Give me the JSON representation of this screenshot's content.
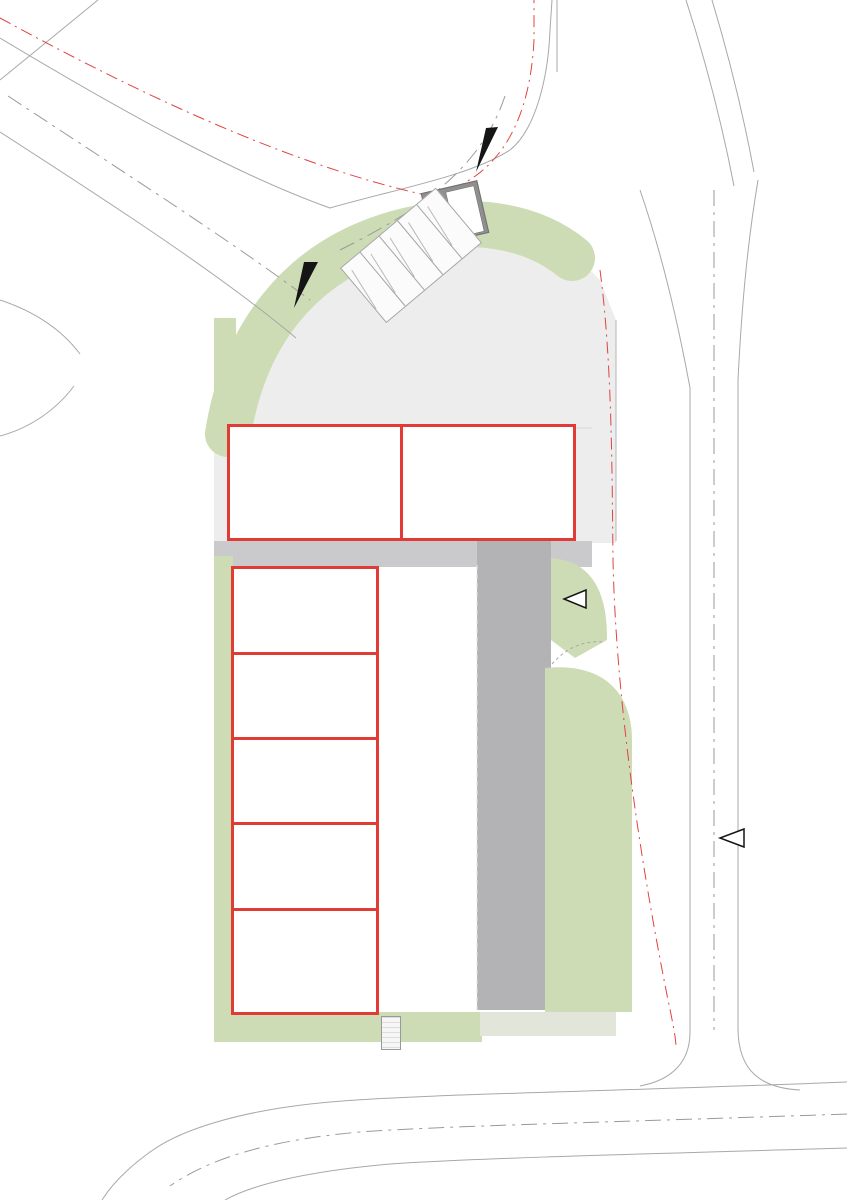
{
  "plots": {
    "a": "PLOT 30A",
    "b": "PLOT 30B"
  },
  "units": [
    {
      "label": "Unit 01"
    },
    {
      "label": "Unit 02"
    },
    {
      "label": "Unit 03"
    },
    {
      "label": "Unit 04"
    },
    {
      "label": "Unit 05"
    },
    {
      "label": "Unit 06"
    },
    {
      "label": "Unit 07"
    }
  ],
  "labels": {
    "ev_space": "EV Space",
    "visitor": "Visitor",
    "ev_active": "EV (Active Charging)",
    "ev_future": "EV (Future Provision)",
    "bin_store": "Bin Store"
  },
  "colors": {
    "unit_outline": "#e03c35",
    "landscape_green": "#cedcb5",
    "tree_green": "#a7c87e",
    "paving": "#ededee",
    "internal_road": "#b3b3b6",
    "dark_bay": "#9b9b9b",
    "ev_yellow": "#c4b636",
    "boundary_red_dash": "#e04343"
  },
  "notes": {
    "sections": [
      {
        "n": [
          95,
          90,
          97,
          60
        ]
      },
      {
        "n": [
          92,
          97,
          88,
          94,
          40
        ]
      },
      {
        "n": [
          90,
          96,
          30
        ]
      },
      {
        "n": [
          85,
          45
        ]
      },
      {
        "scalebar": true
      },
      {
        "h": "Plot 30A",
        "n": [
          88,
          80
        ]
      },
      {
        "n": [
          90,
          85,
          50
        ]
      },
      {
        "n": [
          95,
          92,
          97,
          90,
          35
        ]
      },
      {
        "n": [
          80
        ]
      },
      {
        "h": "Plot 30B",
        "n": [
          82,
          80,
          82,
          80,
          82,
          55
        ]
      },
      {
        "n": [
          75
        ]
      },
      {
        "n": [
          92,
          88,
          45
        ]
      },
      {
        "n": [
          95,
          90,
          96,
          50
        ]
      },
      {
        "n": [
          88,
          30
        ]
      },
      {
        "n": [
          94,
          97,
          92,
          96,
          90,
          40
        ]
      },
      {
        "n": [
          90,
          95,
          85,
          97,
          45
        ]
      },
      {
        "legend": [
          60,
          52,
          58,
          45,
          40
        ]
      },
      {
        "n": [
          70,
          20
        ]
      }
    ]
  },
  "corner_note": {
    "lines": [
      60,
      72,
      55,
      65
    ]
  },
  "scale_bar": {
    "segments": 6
  },
  "site": {
    "trees": [
      [
        240,
        329,
        8
      ],
      [
        271,
        293,
        8
      ],
      [
        309,
        260,
        8
      ],
      [
        352,
        234,
        8
      ],
      [
        400,
        216,
        9
      ],
      [
        448,
        208,
        9
      ],
      [
        538,
        331,
        7
      ],
      [
        554,
        305,
        6
      ],
      [
        379,
        356,
        7
      ],
      [
        420,
        355,
        7
      ],
      [
        222,
        325,
        6
      ],
      [
        520,
        566,
        7
      ],
      [
        553,
        565,
        7
      ],
      [
        571,
        686,
        7
      ],
      [
        589,
        685,
        6
      ],
      [
        602,
        712,
        7
      ],
      [
        601,
        735,
        7
      ],
      [
        567,
        761,
        7
      ],
      [
        602,
        761,
        6
      ],
      [
        586,
        779,
        7
      ],
      [
        560,
        857,
        7
      ],
      [
        578,
        906,
        6
      ],
      [
        565,
        950,
        7
      ],
      [
        596,
        957,
        7
      ],
      [
        579,
        977,
        7
      ],
      [
        250,
        1023,
        7
      ],
      [
        310,
        1027,
        7
      ],
      [
        416,
        1028,
        7
      ],
      [
        466,
        1028,
        6
      ]
    ],
    "trucks": [
      [
        385,
        572,
        "h"
      ],
      [
        385,
        706,
        "h"
      ],
      [
        385,
        868,
        "h"
      ],
      [
        385,
        918,
        "h"
      ],
      [
        327,
        354,
        "v"
      ],
      [
        457,
        354,
        "v"
      ]
    ],
    "grids": [
      {
        "x": 348,
        "y": 360,
        "w": 66,
        "h": 56,
        "c": 2,
        "rows": [
          18,
          37
        ],
        "labels": [
          {
            "dx": 2,
            "dy": 38,
            "w": 30,
            "k": "ev_future"
          },
          {
            "dx": 34,
            "dy": 38,
            "w": 30,
            "k": "ev_space"
          }
        ]
      },
      {
        "x": 397,
        "y": 610,
        "w": 76,
        "h": 40,
        "c": 4,
        "rows": []
      },
      {
        "x": 397,
        "y": 656,
        "w": 76,
        "h": 40,
        "c": 4,
        "rows": []
      },
      {
        "x": 397,
        "y": 745,
        "w": 76,
        "h": 70,
        "c": 4,
        "rows": [
          35
        ]
      },
      {
        "x": 397,
        "y": 952,
        "w": 76,
        "h": 58,
        "c": 3,
        "rows": [
          28
        ],
        "labels": [
          {
            "dx": 26,
            "dy": 34,
            "w": 24,
            "k": "ev_space"
          },
          {
            "dx": 51,
            "dy": 34,
            "w": 24,
            "k": "ev_space"
          }
        ]
      },
      {
        "x": 448,
        "y": 566,
        "w": 28,
        "h": 42,
        "c": 2,
        "rows": []
      }
    ],
    "dark_bays": [
      {
        "x": 552,
        "y": 697,
        "w": 46,
        "h": 17,
        "k": "ev_space"
      },
      {
        "x": 552,
        "y": 717,
        "w": 46,
        "h": 17,
        "k": "ev_space"
      },
      {
        "x": 552,
        "y": 737,
        "w": 46,
        "h": 17,
        "k": "ev_space"
      },
      {
        "x": 556,
        "y": 764,
        "w": 26,
        "h": 12,
        "k": "visitor"
      },
      {
        "x": 556,
        "y": 779,
        "w": 26,
        "h": 12,
        "k": "visitor"
      },
      {
        "x": 553,
        "y": 791,
        "w": 52,
        "h": 22,
        "k": "ev_space",
        "icon": true
      },
      {
        "x": 553,
        "y": 818,
        "w": 52,
        "h": 22,
        "k": "ev_space",
        "icon": true
      },
      {
        "x": 558,
        "y": 893,
        "w": 34,
        "h": 30,
        "k": "bin_store"
      }
    ],
    "white_bays": [
      {
        "x": 238,
        "y": 340,
        "w": 54,
        "h": 28,
        "k": "ev_space",
        "icon": "right"
      },
      {
        "x": 238,
        "y": 374,
        "w": 52,
        "h": 19,
        "k": "ev_space"
      },
      {
        "x": 238,
        "y": 395,
        "w": 52,
        "h": 19,
        "k": "ev_space"
      },
      {
        "x": 532,
        "y": 363,
        "w": 54,
        "h": 32,
        "k": "ev_active",
        "icon": "left"
      }
    ],
    "hatches": [
      [
        230,
        332,
        70,
        44
      ],
      [
        526,
        356,
        66,
        44
      ],
      [
        548,
        786,
        62,
        58
      ],
      [
        443,
        836,
        35,
        34
      ]
    ],
    "tans": [
      [
        349,
        416,
        66,
        12,
        "#cfc7b8"
      ],
      [
        526,
        400,
        66,
        26,
        "#bdb4a4"
      ],
      [
        383,
        606,
        11,
        92,
        "#cfc7b8"
      ],
      [
        383,
        749,
        11,
        66,
        "#cfc7b8"
      ],
      [
        228,
        403,
        34,
        13,
        "#bdb4a4"
      ]
    ],
    "ev_icons": [
      [
        406,
        622
      ],
      [
        402,
        796
      ],
      [
        410,
        972
      ]
    ],
    "disabled_icons": [
      [
        392,
        668
      ],
      [
        392,
        844
      ]
    ],
    "stands": [
      [
        556,
        933
      ],
      [
        565,
        933
      ],
      [
        574,
        933
      ],
      [
        583,
        933
      ]
    ],
    "balloon_markers": [
      [
        385,
        333
      ],
      [
        305,
        549
      ],
      [
        303,
        1031
      ],
      [
        409,
        773
      ]
    ],
    "side_markers": [
      [
        192,
        479,
        "r"
      ],
      [
        631,
        479,
        "l"
      ],
      [
        190,
        776,
        "r"
      ]
    ]
  }
}
